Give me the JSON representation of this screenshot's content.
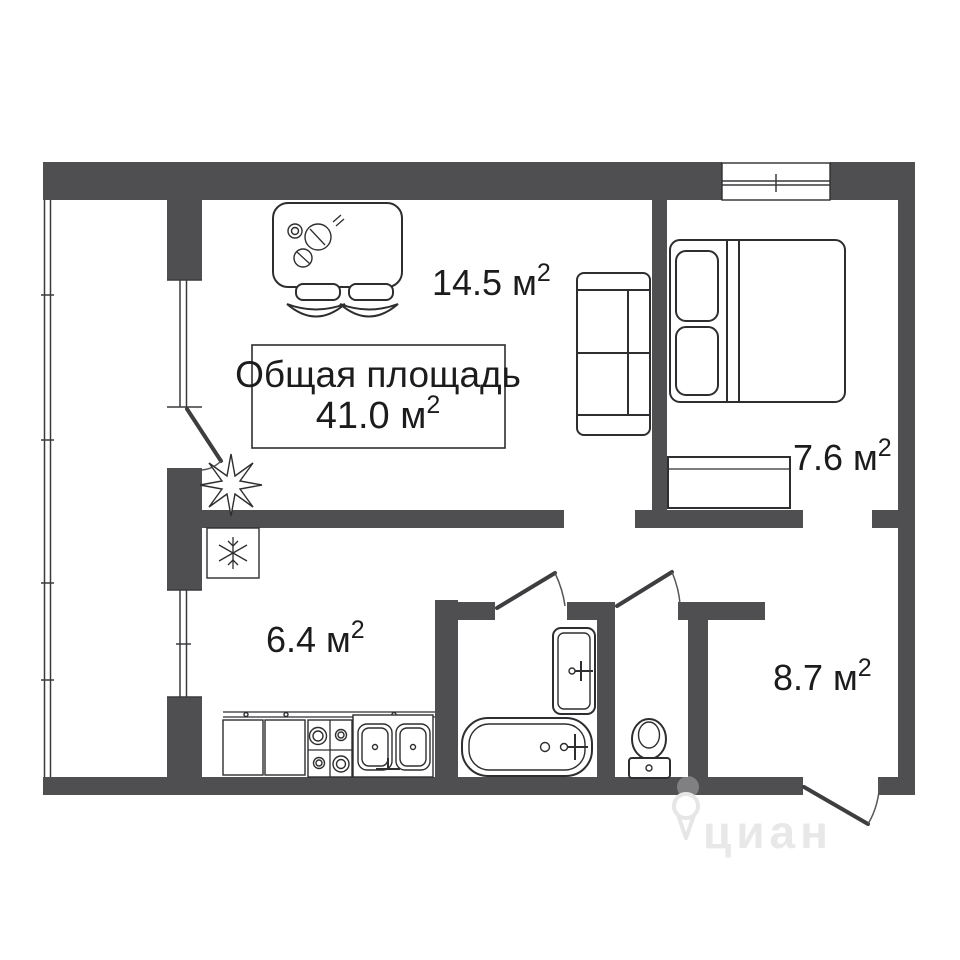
{
  "plan": {
    "summary": {
      "line1": "Общая площадь",
      "value": "41.0 м",
      "sup": "2"
    },
    "rooms": {
      "living": {
        "value": "14.5 м",
        "sup": "2"
      },
      "bedroom": {
        "value": "7.6 м",
        "sup": "2"
      },
      "kitchen": {
        "value": "6.4 м",
        "sup": "2"
      },
      "hallway": {
        "value": "8.7 м",
        "sup": "2"
      }
    }
  },
  "icons": {
    "fridge": "snowflake-icon",
    "plant": "plant-icon",
    "watermark_pin": "map-pin-icon"
  },
  "watermark": {
    "brand": "циан"
  },
  "colors": {
    "wall": "#4f4f52",
    "line": "#2e2e30",
    "text": "#1c1c1e",
    "background": "#ffffff",
    "watermark": "#e8e8e8"
  }
}
